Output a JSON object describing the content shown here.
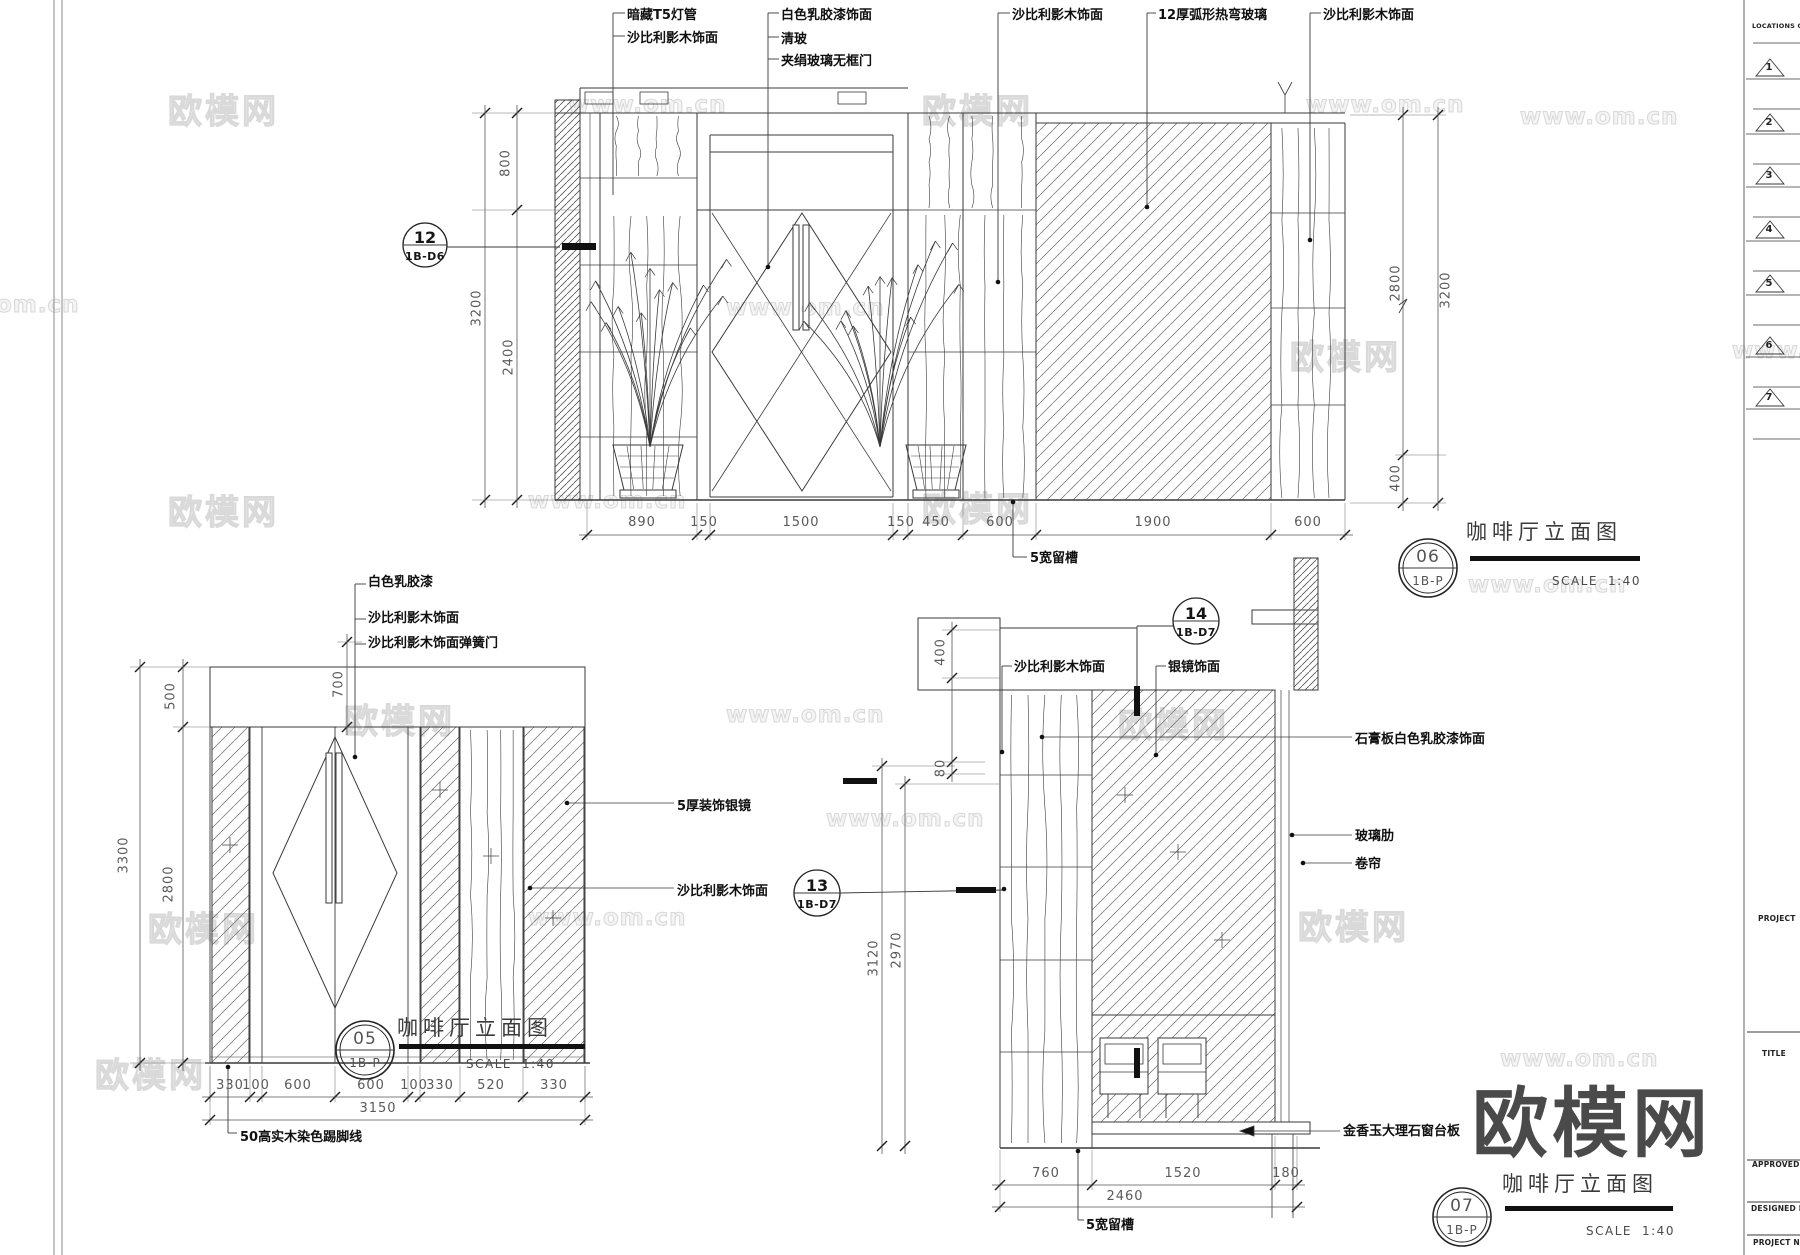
{
  "watermarks": {
    "cn": "欧模网",
    "url": "www.om.cn",
    "url_partial": "om.cn",
    "logo": "欧模网"
  },
  "sidebar": {
    "locations_label": "LOCATIONS OF",
    "markers": [
      "1",
      "2",
      "3",
      "4",
      "5",
      "6",
      "7"
    ],
    "project_label": "PROJECT",
    "title_label": "TITLE",
    "approved_label": "APPROVED B",
    "designed_label": "DESIGNED B",
    "project_no_label": "PROJECT NO"
  },
  "d06": {
    "callout": {
      "num": "12",
      "ref": "1B-D6"
    },
    "ann": {
      "a1": "暗藏T5灯管",
      "a2": "沙比利影木饰面",
      "a3": "白色乳胶漆饰面",
      "a4": "清玻",
      "a5": "夹绢玻璃无框门",
      "a6": "沙比利影木饰面",
      "a7": "12厚弧形热弯玻璃",
      "a8": "沙比利影木饰面",
      "slot": "5宽留槽"
    },
    "dims": {
      "b1": "890",
      "b2": "150",
      "b3": "1500",
      "b4": "150",
      "b5": "450",
      "b6": "600",
      "b7": "1900",
      "b8": "600",
      "l1": "800",
      "l2": "3200",
      "l3": "2400",
      "r1": "2800",
      "r2": "3200",
      "r3": "400"
    },
    "title": {
      "num": "06",
      "ref": "1B-P",
      "name": "咖啡厅立面图",
      "scale_label": "SCALE",
      "scale_value": "1:40"
    }
  },
  "d05": {
    "ann": {
      "a1": "白色乳胶漆",
      "a2": "沙比利影木饰面",
      "a3": "沙比利影木饰面弹簧门",
      "a4": "5厚装饰银镜",
      "a5": "沙比利影木饰面",
      "a6": "50高实木染色踢脚线"
    },
    "callout": {
      "num": "13",
      "ref": "1B-D7"
    },
    "dims": {
      "b1": "330",
      "b2": "100",
      "b3": "600",
      "b4": "600",
      "b5": "100",
      "b6": "330",
      "b7": "520",
      "b8": "330",
      "total": "3150",
      "l1": "3300",
      "l2": "500",
      "l3": "2800",
      "l4": "700"
    },
    "title": {
      "num": "05",
      "ref": "1B-P",
      "name": "咖啡厅立面图",
      "scale_label": "SCALE",
      "scale_value": "1:40"
    }
  },
  "d07": {
    "callout": {
      "num": "14",
      "ref": "1B-D7"
    },
    "ann": {
      "a1": "沙比利影木饰面",
      "a2": "银镜饰面",
      "a3": "石膏板白色乳胶漆饰面",
      "a4": "玻璃肋",
      "a5": "卷帘",
      "a6": "金香玉大理石窗台板",
      "slot": "5宽留槽"
    },
    "dims": {
      "b1": "760",
      "b2": "1520",
      "b3": "180",
      "total": "2460",
      "l1": "3120",
      "l2": "2970",
      "l3": "400",
      "l4": "80"
    },
    "title": {
      "num": "07",
      "ref": "1B-P",
      "name": "咖啡厅立面图",
      "scale_label": "SCALE",
      "scale_value": "1:40"
    }
  }
}
